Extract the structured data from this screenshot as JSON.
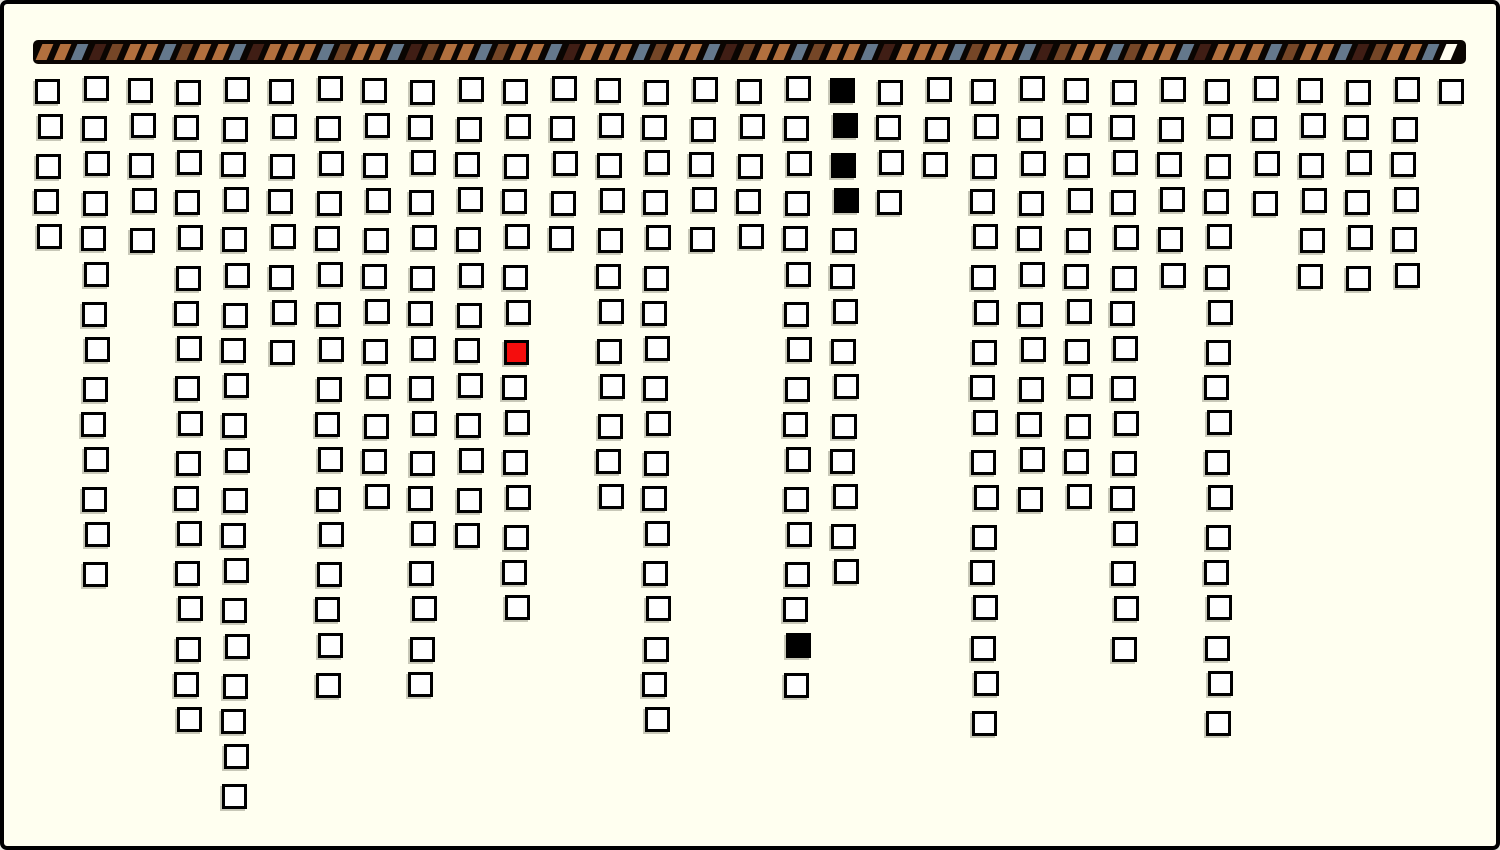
{
  "canvas": {
    "width": 1500,
    "height": 850,
    "background": "#FFFFF0",
    "frame_color": "#000000",
    "frame_border": 4
  },
  "progress_bar": {
    "x": 33,
    "y": 40,
    "width": 1433,
    "height": 24,
    "background": "#0A0502",
    "stripe_geometry": {
      "start_pad": 6,
      "period": 17.55,
      "stripe_width": 10.5,
      "stripe_height": 16,
      "stripe_top": 4,
      "skew_deg": -23
    },
    "palette": {
      "o": "#B2703E",
      "s": "#64788C",
      "m": "#401E15",
      "b": "#754627",
      "w": "#FFFDF0"
    },
    "stripes": [
      "o",
      "o",
      "s",
      "m",
      "b",
      "o",
      "o",
      "s",
      "b",
      "o",
      "o",
      "s",
      "m",
      "o",
      "o",
      "o",
      "s",
      "b",
      "o",
      "o",
      "s",
      "m",
      "b",
      "o",
      "o",
      "s",
      "b",
      "o",
      "o",
      "s",
      "m",
      "o",
      "o",
      "o",
      "s",
      "b",
      "o",
      "o",
      "s",
      "m",
      "b",
      "o",
      "o",
      "s",
      "b",
      "o",
      "o",
      "s",
      "m",
      "o",
      "o",
      "o",
      "s",
      "b",
      "o",
      "o",
      "s",
      "m",
      "b",
      "o",
      "o",
      "s",
      "b",
      "o",
      "o",
      "s",
      "m",
      "o",
      "o",
      "o",
      "s",
      "b",
      "o",
      "o",
      "s",
      "m",
      "b",
      "o",
      "o",
      "s",
      "w"
    ]
  },
  "grid": {
    "origin_x": 36,
    "origin_y": 78,
    "col_pitch": 46.8,
    "row_pitch": 37.1,
    "cell_size": 25,
    "cell_border": 3,
    "cell_fill": "#FFFFFF",
    "cell_border_color": "#000000",
    "filled_color": "#000000",
    "highlight_color": "#F50D0D",
    "total_columns": 31,
    "total_blocks": 332
  },
  "columns": [
    {
      "i": 1,
      "n": 5
    },
    {
      "i": 2,
      "n": 14
    },
    {
      "i": 3,
      "n": 5
    },
    {
      "i": 4,
      "n": 18
    },
    {
      "i": 5,
      "n": 20
    },
    {
      "i": 6,
      "n": 8
    },
    {
      "i": 7,
      "n": 17
    },
    {
      "i": 8,
      "n": 12
    },
    {
      "i": 9,
      "n": 17
    },
    {
      "i": 10,
      "n": 13
    },
    {
      "i": 11,
      "n": 15,
      "red": [
        8
      ]
    },
    {
      "i": 12,
      "n": 5
    },
    {
      "i": 13,
      "n": 12
    },
    {
      "i": 14,
      "n": 18
    },
    {
      "i": 15,
      "n": 5
    },
    {
      "i": 16,
      "n": 5
    },
    {
      "i": 17,
      "n": 17,
      "black": [
        16
      ]
    },
    {
      "i": 18,
      "n": 14,
      "black": [
        1,
        2,
        3,
        4
      ]
    },
    {
      "i": 19,
      "n": 4
    },
    {
      "i": 20,
      "n": 3
    },
    {
      "i": 21,
      "n": 18
    },
    {
      "i": 22,
      "n": 12
    },
    {
      "i": 23,
      "n": 12
    },
    {
      "i": 24,
      "n": 16
    },
    {
      "i": 25,
      "n": 6
    },
    {
      "i": 26,
      "n": 18
    },
    {
      "i": 27,
      "n": 4
    },
    {
      "i": 28,
      "n": 6
    },
    {
      "i": 29,
      "n": 6
    },
    {
      "i": 30,
      "n": 6
    },
    {
      "i": 31,
      "n": 1
    }
  ]
}
